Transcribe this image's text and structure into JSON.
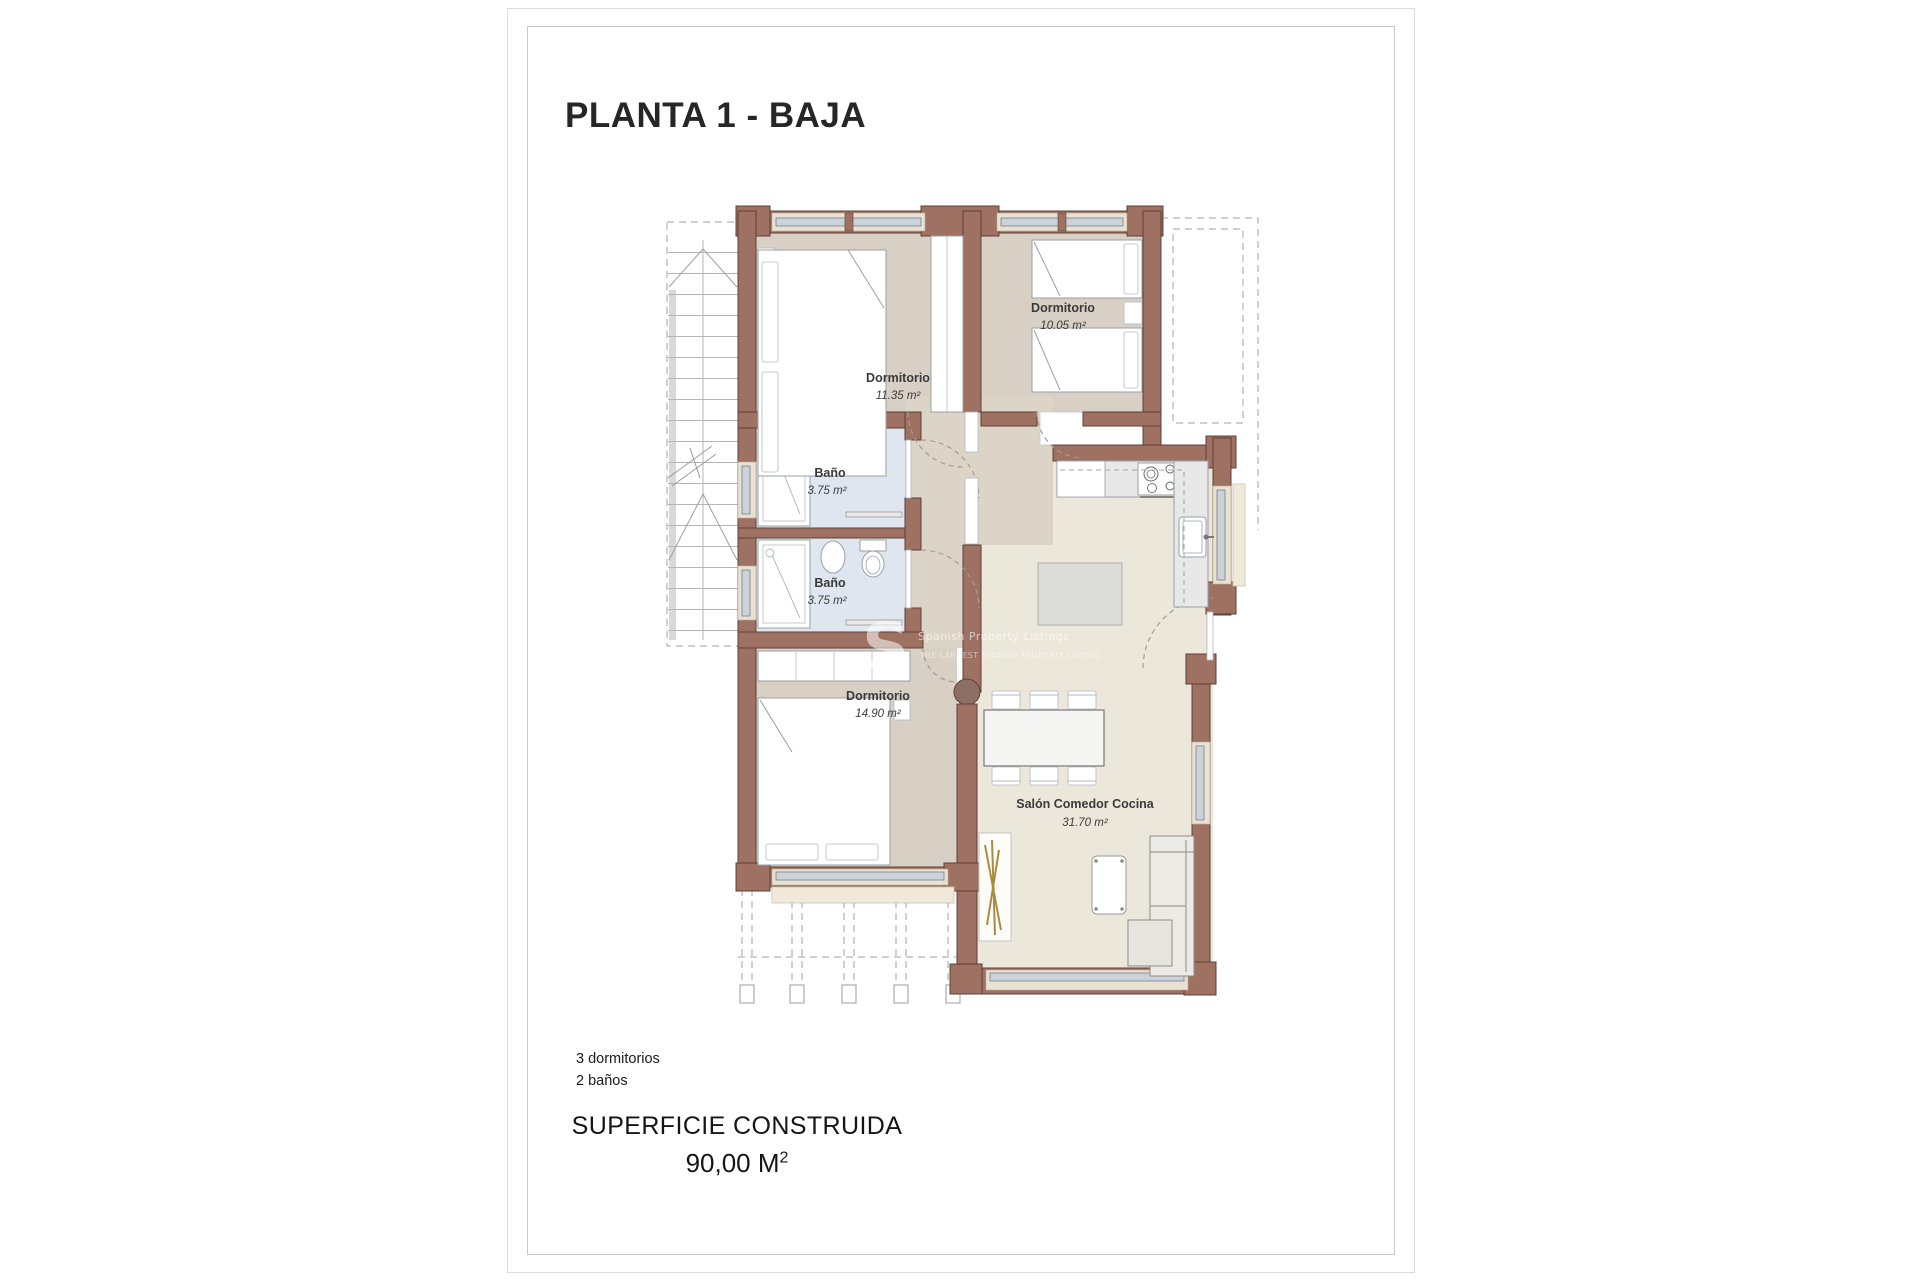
{
  "page": {
    "title": "PLANTA 1 - BAJA"
  },
  "rooms": [
    {
      "name": "Dormitorio",
      "area": "11.35 m²"
    },
    {
      "name": "Dormitorio",
      "area": "10.05 m²"
    },
    {
      "name": "Baño",
      "area": "3.75 m²"
    },
    {
      "name": "Baño",
      "area": "3.75 m²"
    },
    {
      "name": "Dormitorio",
      "area": "14.90 m²"
    },
    {
      "name": "Salón Comedor Cocina",
      "area": "31.70 m²"
    }
  ],
  "watermark": {
    "logo": "S",
    "line1": "Spanish Property Listings",
    "line2": "THE LARGEST SPANISH PROPERTY LISTING"
  },
  "summary": [
    "3 dormitorios",
    "2 baños"
  ],
  "surface": {
    "label": "SUPERFICIE CONSTRUIDA",
    "value": "90,00 M",
    "sup": "2"
  },
  "colors": {
    "wall": "#9e7163",
    "wall_outline": "#5d4037",
    "floor_bedroom": "#d8d0c4",
    "floor_hall": "#ddd4c8",
    "floor_living": "#ebe7da",
    "floor_bath": "#dfe6ef",
    "window_glass": "#ccd2d9"
  }
}
